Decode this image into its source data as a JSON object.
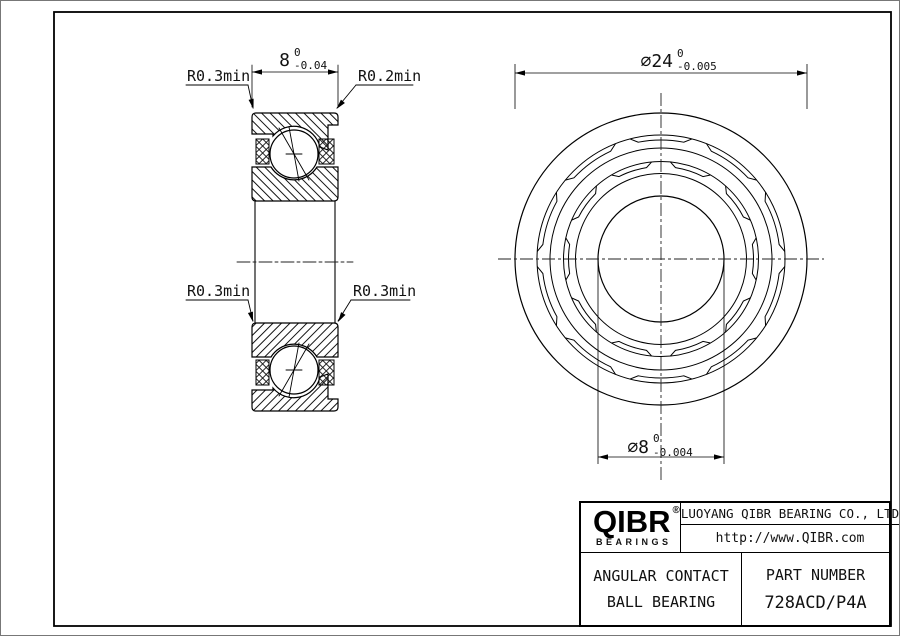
{
  "section_view": {
    "labels": [
      {
        "text": "R0.3min"
      },
      {
        "text": "R0.2min"
      },
      {
        "text": "R0.3min"
      },
      {
        "text": "R0.3min"
      }
    ],
    "width_dim": {
      "value": "8",
      "upper": "0",
      "lower": "-0.04"
    }
  },
  "front_view": {
    "od_dim": {
      "value": "⌀24",
      "upper": "0",
      "lower": "-0.005"
    },
    "bore_dim": {
      "value": "⌀8",
      "upper": "0",
      "lower": "-0.004"
    }
  },
  "title_block": {
    "logo": {
      "text": "QIBR",
      "registered": "®",
      "sub": "BEARINGS"
    },
    "company": "LUOYANG QIBR BEARING CO., LTD",
    "website": "http://www.QIBR.com",
    "product_line1": "ANGULAR CONTACT",
    "product_line2": "BALL BEARING",
    "part_number_label": "PART NUMBER",
    "part_number": "728ACD/P4A"
  }
}
